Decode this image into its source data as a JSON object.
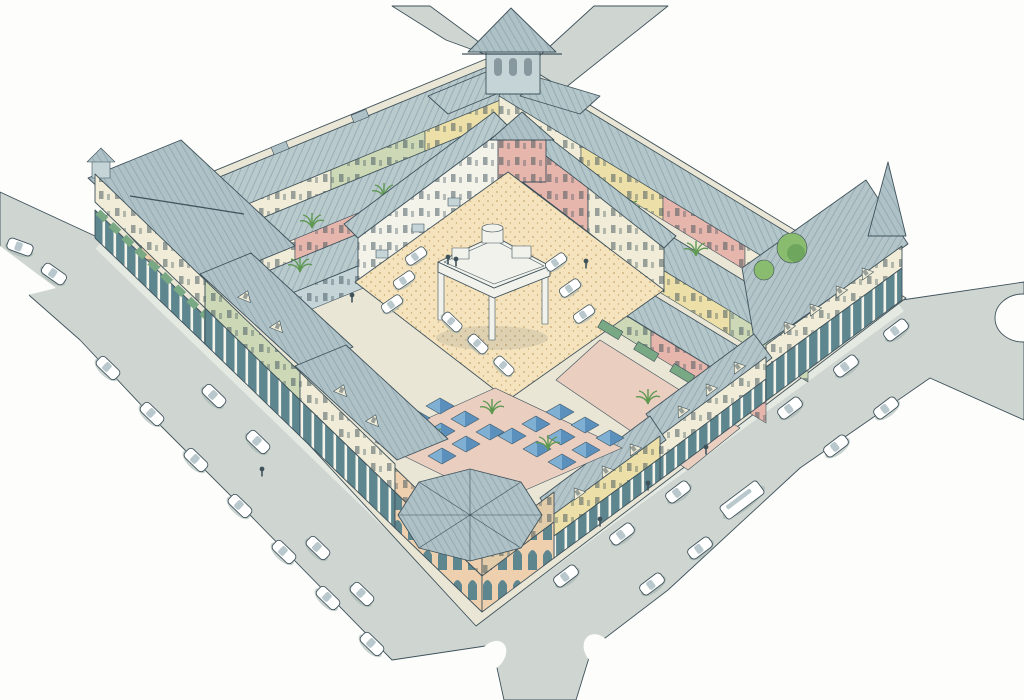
{
  "meta": {
    "title": "Aerial watercolor rendering of a mixed-use urban block",
    "description": "Bird's-eye pen-and-watercolor illustration of a square city block: perimeter buildings with slate roofs, corner towers and turrets, arcaded sidewalks with green awnings, an inner sand-colored parking court with a central open pavilion, a courtyard of blue market canopies, palm trees, and surrounding gray streets with parked cars and a bus."
  },
  "colors": {
    "bg": "#fdfdfb",
    "line": "#3f525b",
    "street": "#cfd6d1",
    "sidewalk": "#e4e9e2",
    "underlay": "#eae6d6",
    "roof_a": "#b9cacd",
    "roof_b": "#b3c6ca",
    "roof_c": "#aec1c6",
    "roof_d": "#b4c5c9",
    "roof_line": "#829aa3",
    "wall_cream": "#f0ecd7",
    "wall_white": "#f3f3ea",
    "wall_peach": "#eed0ae",
    "wall_pink": "#e6b6ad",
    "wall_yellow": "#ece0a8",
    "wall_green": "#cdd8b6",
    "wall_blue": "#c4d4d7",
    "wall_tan": "#e3cca9",
    "arcade": "#5d868f",
    "awning": "#79a884",
    "umbrella": "#7fb0d4",
    "umbrella_dark": "#3f77a8",
    "plaza": "#f4e3bd",
    "plaza_dot": "#c9a76e",
    "court": "#eacfc1",
    "car": "#ffffff",
    "car_shadow": "#9fb0ac",
    "glass": "#b9c8cc",
    "tree": "#8abc70",
    "tree_dark": "#5e9851",
    "pavilion": "#f2f2ec"
  },
  "scene": {
    "view": "aerial three-quarter (bird's-eye) from the south",
    "block": {
      "shape": "diamond (rotated square) city block",
      "perimeter_features": [
        "top corner tower with pyramidal roof",
        "left corner building with rooftop lantern and green awnings",
        "bottom corner building with arched arcade and ribbed conical roof",
        "right corner building with spire turret and dormered hip roof",
        "arcaded colonnades along both street frontages"
      ],
      "wall_colors_seen": [
        "cream",
        "white",
        "peach",
        "pink",
        "yellow",
        "pale green",
        "blue-gray"
      ],
      "interior": [
        "sand-colored parking plaza with stippled paving",
        "central two-story open pavilion with rooftop water tank",
        "courtyard of square blue market canopies",
        "courtyard with green cafe awnings and pink paving",
        "palm trees and round shade trees"
      ]
    },
    "streets": {
      "visible_sides": 2,
      "exits": [
        "top-left",
        "top-right",
        "left edge",
        "right edge",
        "bottom edge"
      ],
      "details": [
        "curb bulb-outs",
        "angled parked cars on both sides"
      ]
    },
    "vehicles": {
      "parked_cars_street": 24,
      "cars_in_plaza": 9,
      "bus": 1
    },
    "people": 8
  }
}
